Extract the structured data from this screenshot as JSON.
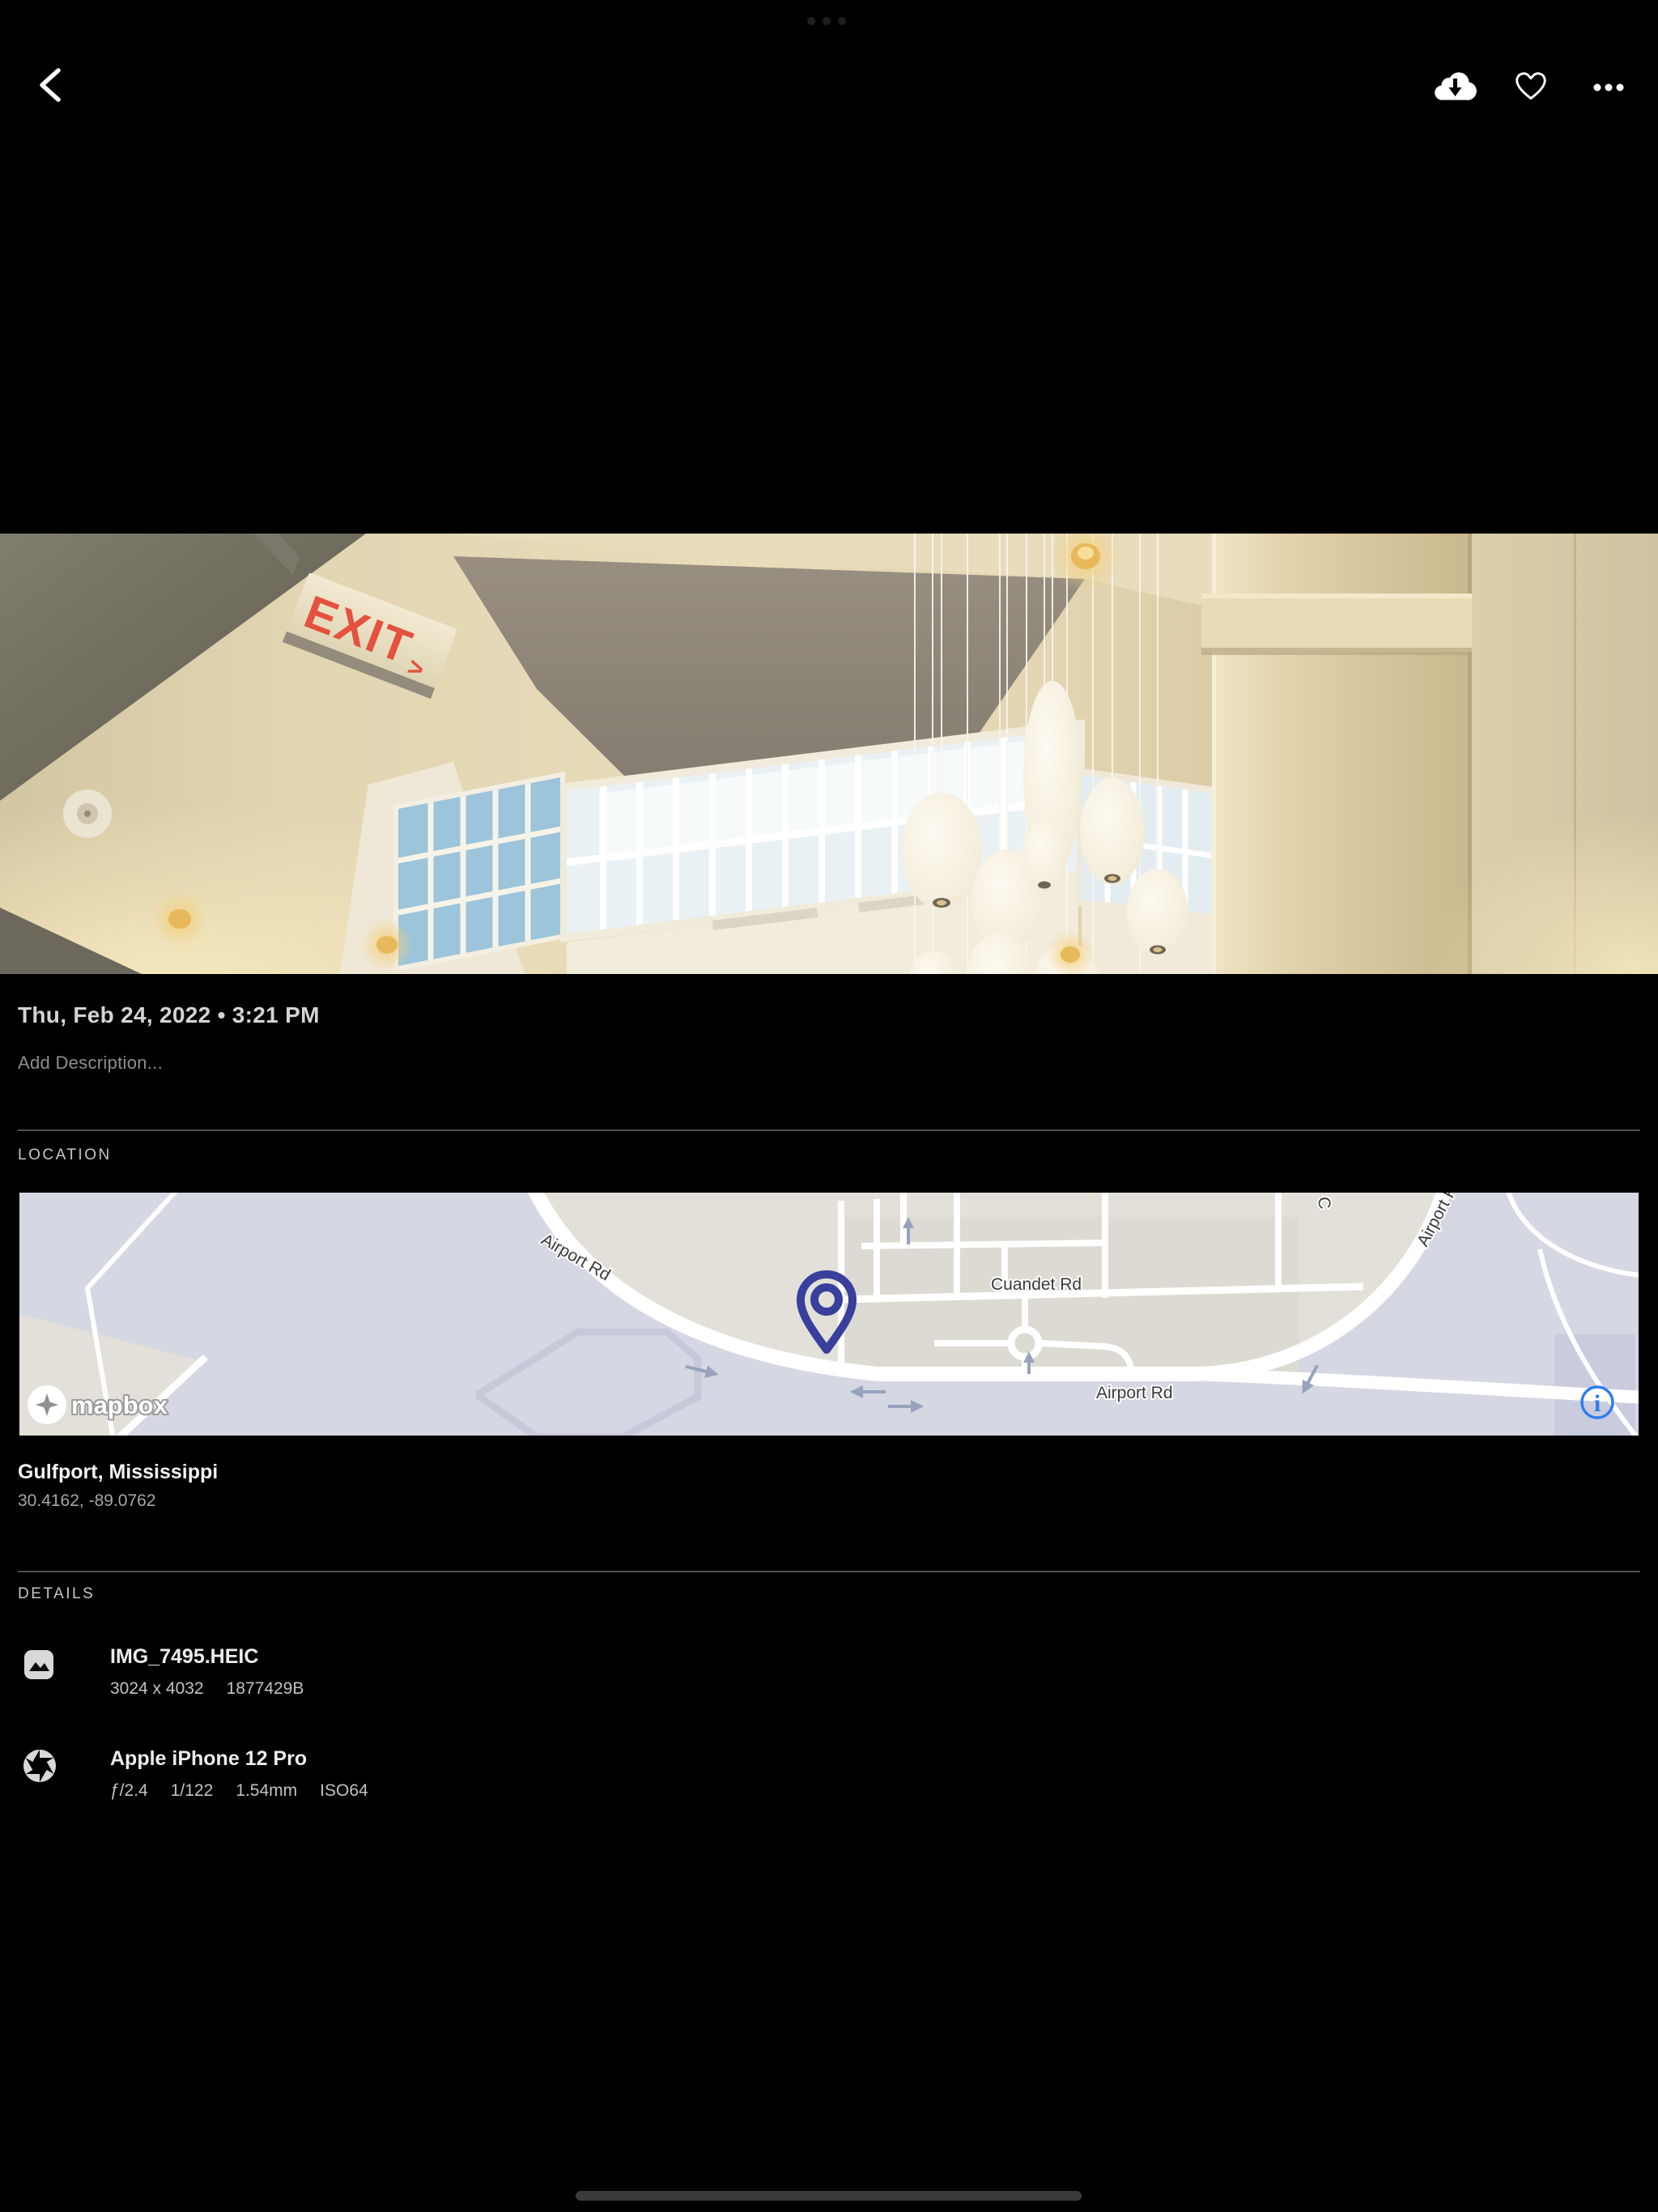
{
  "topbar": {
    "back_icon": "chevron-left",
    "download_icon": "cloud-download",
    "favorite_icon": "heart-outline",
    "more_icon": "ellipsis-horizontal"
  },
  "photo": {
    "exit_text": "EXIT",
    "exit_arrow": ">"
  },
  "info": {
    "date": "Thu, Feb 24, 2022 • 3:21 PM",
    "description_placeholder": "Add Description..."
  },
  "location": {
    "header": "LOCATION",
    "place": "Gulfport, Mississippi",
    "coordinates": "30.4162, -89.0762",
    "map": {
      "airport_rd_diagonal": "Airport Rd",
      "cuandet_rd": "Cuandet Rd",
      "airport_rd_main": "Airport Rd",
      "airport_rd_ne": "Airport Rd",
      "street_c": "C",
      "attribution": "mapbox",
      "pin_color": "#383f9c",
      "info_icon_color": "#2e7cf6"
    }
  },
  "details": {
    "header": "DETAILS",
    "file": {
      "name": "IMG_7495.HEIC",
      "dimensions": "3024 x 4032",
      "size": "1877429B"
    },
    "camera": {
      "name": "Apple iPhone 12 Pro",
      "aperture": "ƒ/2.4",
      "shutter": "1/122",
      "focal_length": "1.54mm",
      "iso": "ISO64"
    }
  }
}
